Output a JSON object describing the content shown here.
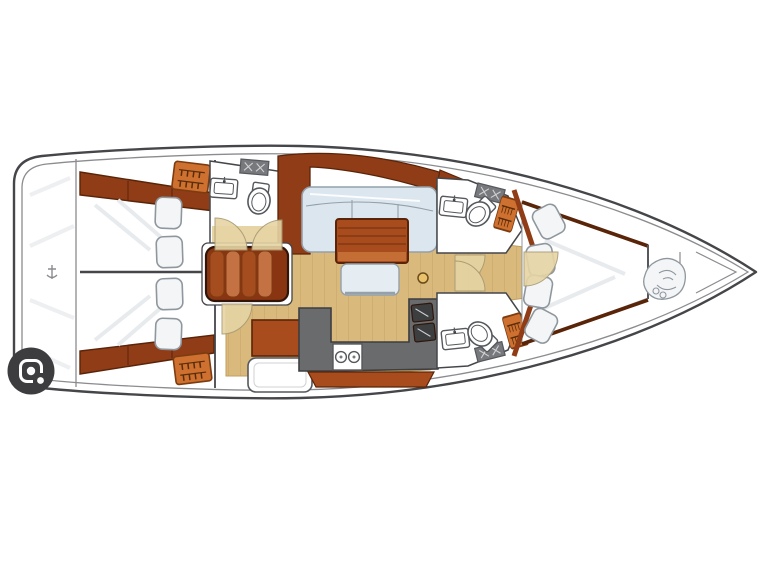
{
  "diagram": {
    "type": "sailboat-interior-floor-plan",
    "label": "Sailing yacht interior layout plan, bow pointing right",
    "orientation": "bow-right",
    "areas": [
      "stern-platform",
      "aft-cabin-port",
      "aft-cabin-starboard",
      "aft-head",
      "companionway-stairs",
      "nav-station",
      "saloon",
      "galley",
      "forward-head-port",
      "forward-head-starboard",
      "forward-cabin",
      "anchor-locker"
    ],
    "fixtures": [
      "double-berth",
      "pillows",
      "hanging-locker",
      "sink",
      "toilet",
      "counter-hatch",
      "stove-two-burners",
      "double-sink",
      "saloon-table",
      "l-shaped-settee",
      "bench-seat",
      "mast-step"
    ]
  },
  "icons": {
    "lens_button": "camera-lens-icon",
    "hanging_locker": "hanger-icon",
    "anchor_locker": "rope-coil-icon",
    "keel_mark": "anchor-icon"
  },
  "colors": {
    "white": "#ffffff",
    "outline": "#45464a",
    "innerline": "#8b8c90",
    "sheen": "#e8ebed",
    "floorWood": "#d9b97c",
    "floorLine": "#c19e5e",
    "tanDoor": "#e6d4a4",
    "doorEdge": "#a89a74",
    "darkWood": "#8f3c17",
    "darkWoodEdge": "#5a2408",
    "midWood": "#a84b1d",
    "lightWood": "#c46d35",
    "orangeLocker": "#cd7030",
    "lockerEdge": "#7c3c10",
    "lockerGlyph": "#5a2c08",
    "stairBase": "#8a3512",
    "stairMid": "#a64d20",
    "stairLight": "#c47243",
    "stairEdge": "#30160a",
    "sofa": "#dce6ee",
    "bench": "#e5edf3",
    "sofaEdge": "#94a0aa",
    "pillow": "#f4f5f6",
    "pillowEdge": "#8f979e",
    "galleyGray": "#6a6b6d",
    "galleyDark": "#3d3e40",
    "fixtureEdge": "#55585c",
    "hatchGray": "#77797c",
    "hatchLine": "#d0d1d3",
    "mastWood": "#e9c26b",
    "mastEdge": "#6b4c1a",
    "lensBg": "#3d3d40",
    "lensFg": "#fafafa"
  }
}
